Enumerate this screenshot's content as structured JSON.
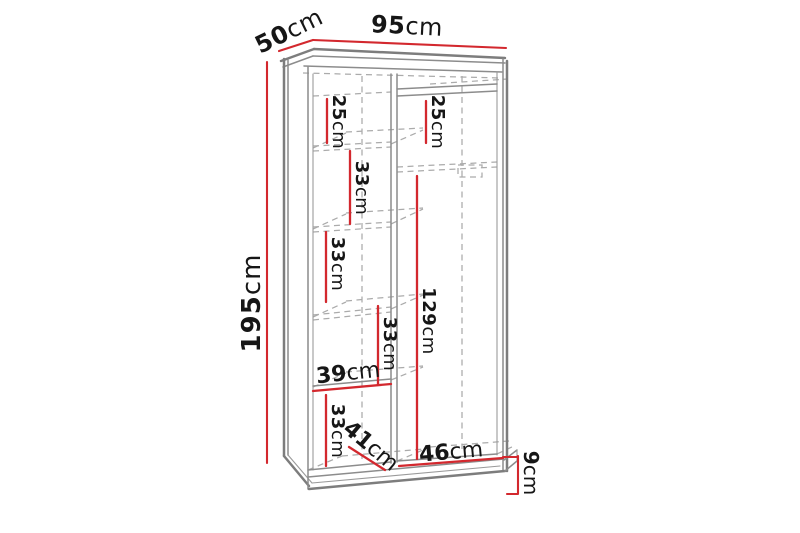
{
  "colors": {
    "background": "#ffffff",
    "dimension_red": "#d3282e",
    "outline_gray": "#8c8c8c",
    "hidden_edge_gray": "#ababab",
    "label_text": "#161616"
  },
  "dims": {
    "width_top": {
      "num": "95",
      "unit": "cm"
    },
    "depth_top": {
      "num": "50",
      "unit": "cm"
    },
    "height_left": {
      "num": "195",
      "unit": "cm"
    },
    "left_top_gap": {
      "num": "25",
      "unit": "cm"
    },
    "left_shelf_gap_1": {
      "num": "33",
      "unit": "cm"
    },
    "left_shelf_gap_2": {
      "num": "33",
      "unit": "cm"
    },
    "left_shelf_gap_3": {
      "num": "33",
      "unit": "cm"
    },
    "left_bottom_gap": {
      "num": "33",
      "unit": "cm"
    },
    "left_inner_width": {
      "num": "39",
      "unit": "cm"
    },
    "left_inner_depth": {
      "num": "41",
      "unit": "cm"
    },
    "right_top_gap": {
      "num": "25",
      "unit": "cm"
    },
    "right_hanging_height": {
      "num": "129",
      "unit": "cm"
    },
    "right_inner_width": {
      "num": "46",
      "unit": "cm"
    },
    "base_height": {
      "num": "9",
      "unit": "cm"
    }
  }
}
